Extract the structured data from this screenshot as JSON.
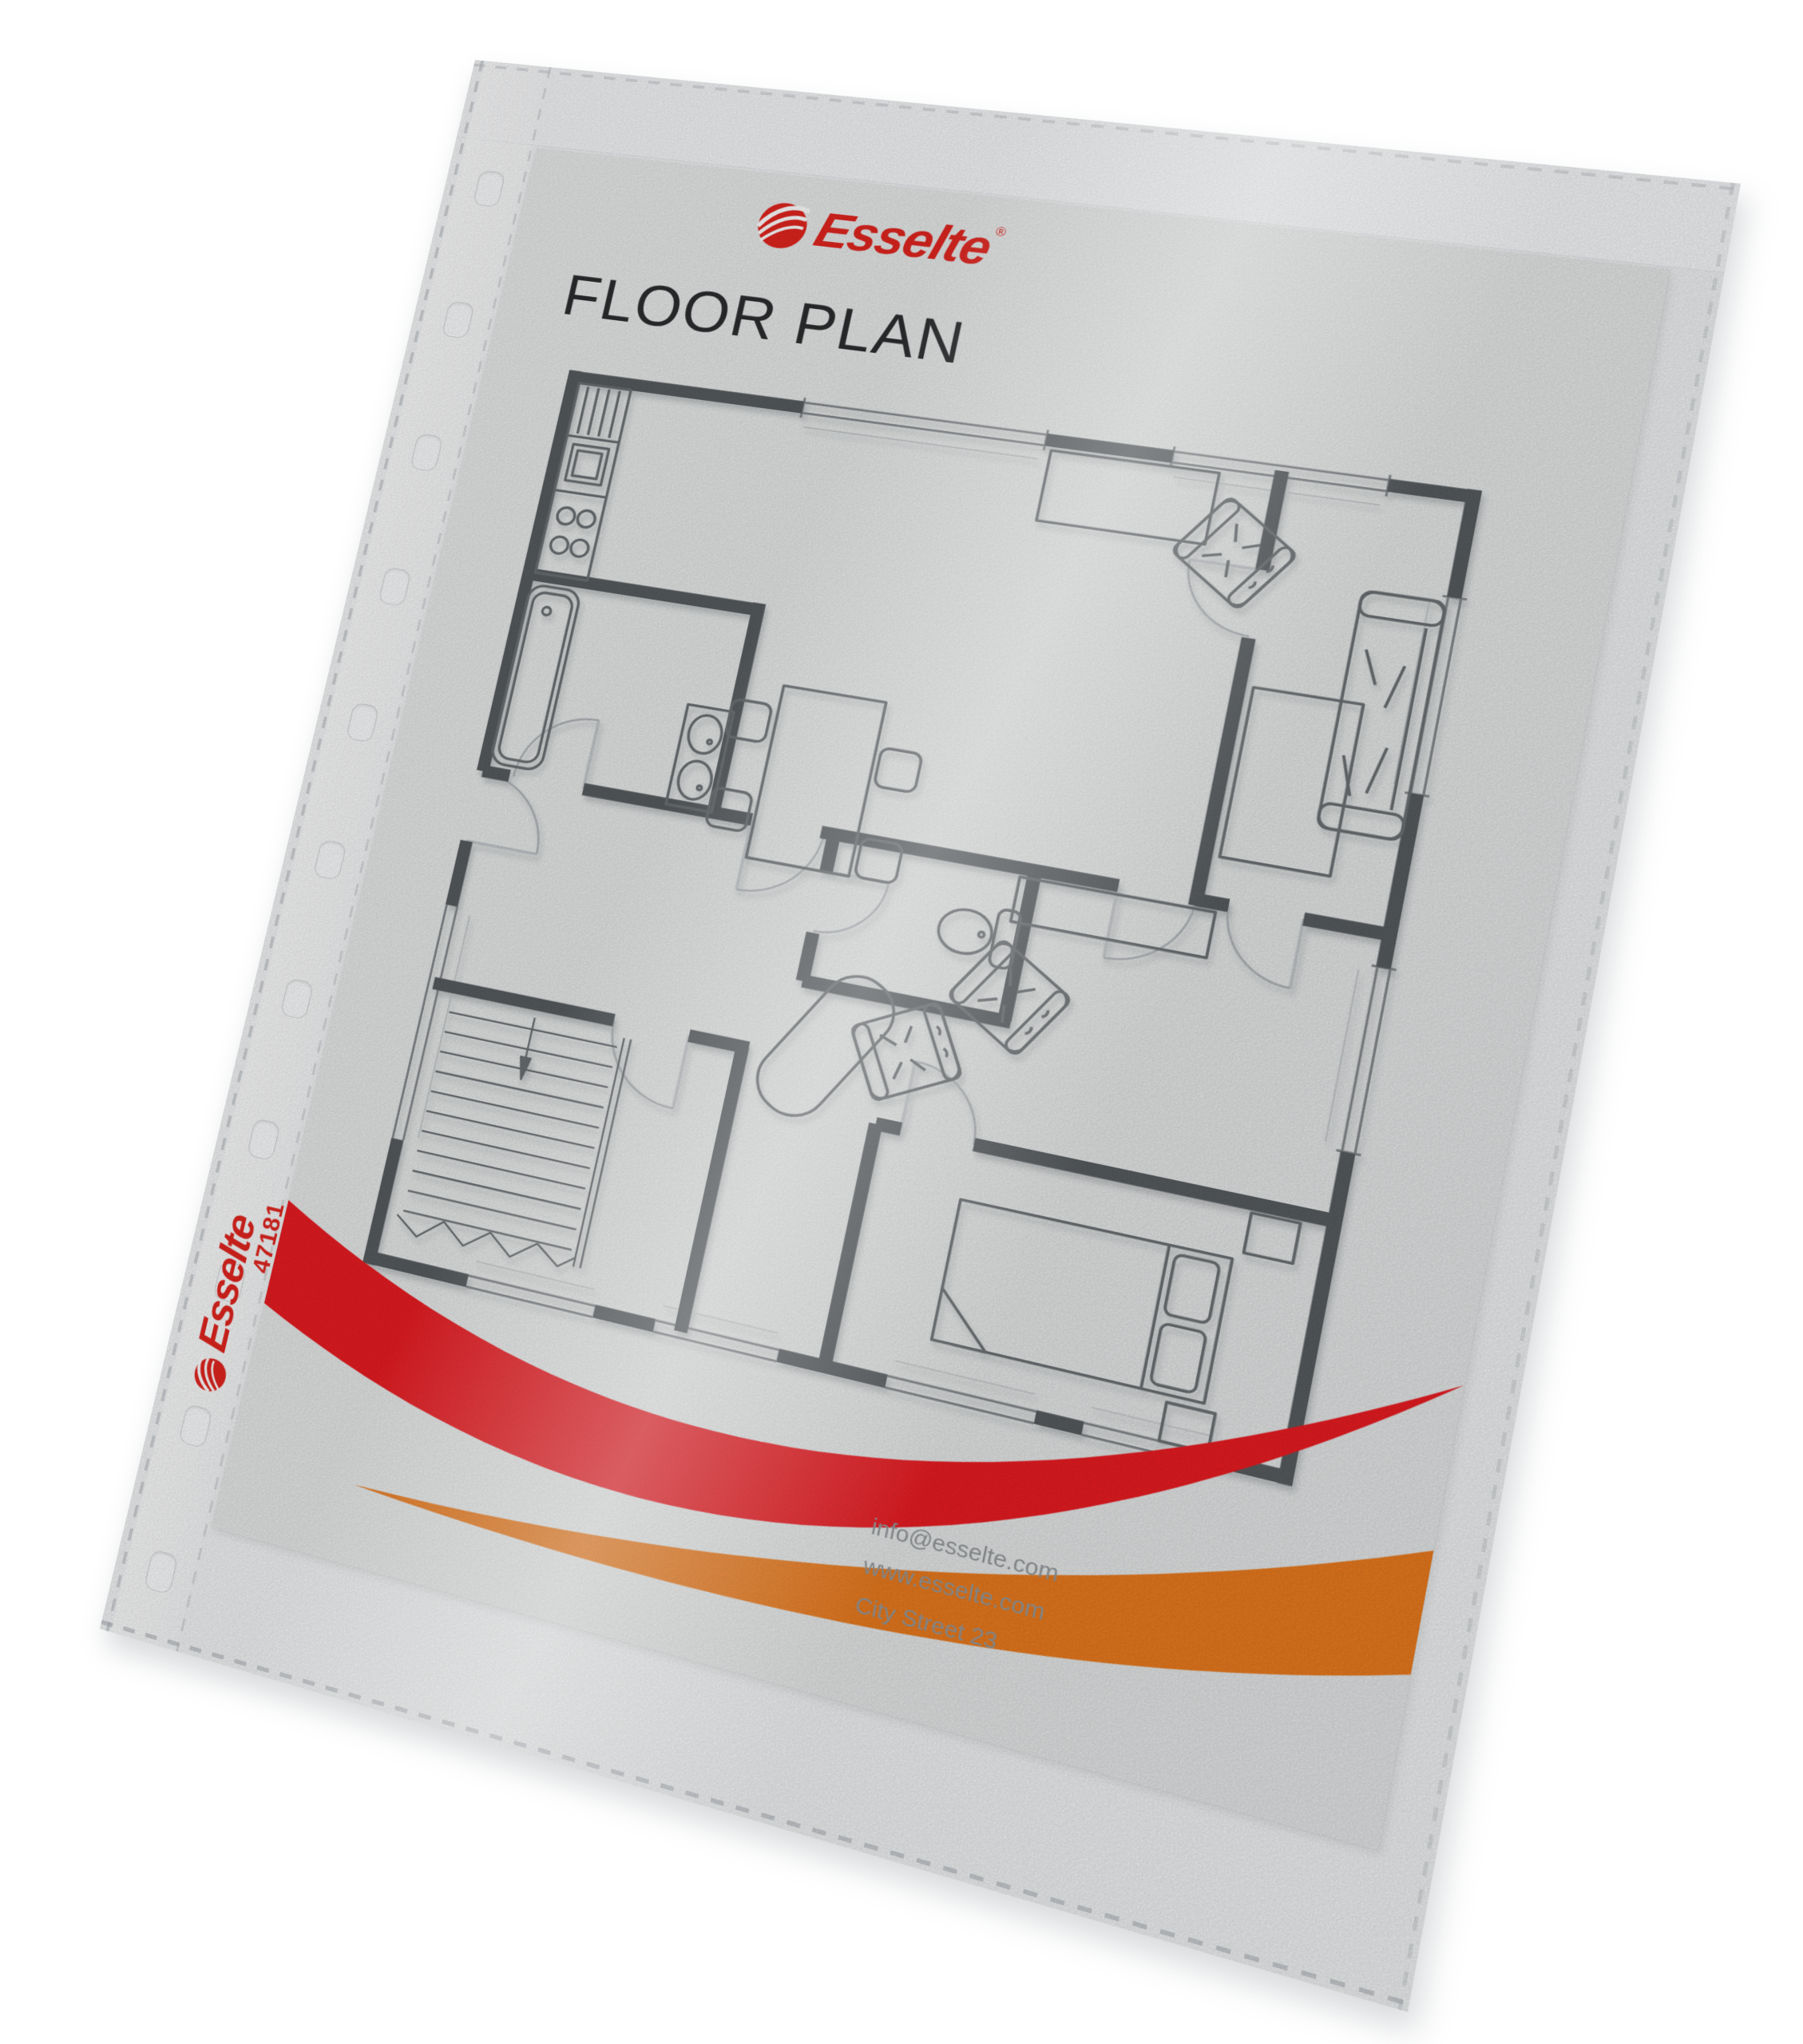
{
  "sleeve": {
    "type_name": "punched-pocket-sheet-protector",
    "punch_hole_count": 11,
    "brand_print": {
      "brand": "Esselte",
      "item_number": "47181"
    }
  },
  "document": {
    "logo": {
      "brand": "Esselte",
      "registered_mark": "®"
    },
    "title": "FLOOR PLAN",
    "footer": {
      "email": "info@esselte.com",
      "website": "www.esselte.com",
      "address": "City Street 23"
    },
    "colors": {
      "brand_red": "#e2251f",
      "swoosh_red": "#e81c22",
      "swoosh_orange": "#e87a1e",
      "wall_grey": "#575c5f",
      "paper_grey": "#e7e9e9"
    }
  },
  "floor_plan": {
    "elements": [
      "kitchen-counter-icon",
      "kitchen-stove-icon",
      "kitchen-sink-icon",
      "bathtub-icon",
      "double-washbasin-icon",
      "toilet-icon",
      "dining-table-icon",
      "chair-icon",
      "sofa-icon",
      "armchair-icon",
      "coffee-table-icon",
      "sideboard-icon",
      "wardrobe-icon",
      "double-bed-icon",
      "nightstand-icon",
      "staircase-icon",
      "door-arc-icon",
      "window-icon"
    ]
  }
}
